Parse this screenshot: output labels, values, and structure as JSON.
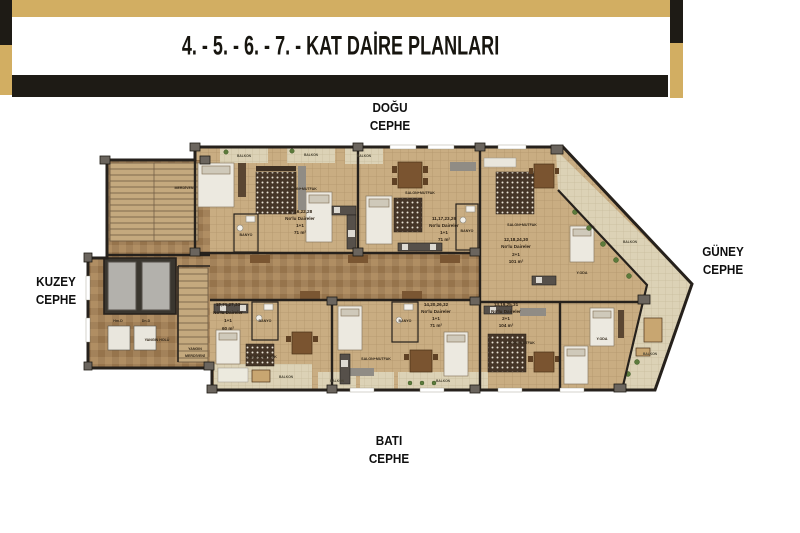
{
  "header": {
    "title": "4. - 5. - 6. - 7. - KAT DAİRE PLANLARI"
  },
  "compass": {
    "east": {
      "line1": "DOĞU",
      "line2": "CEPHE"
    },
    "north": {
      "line1": "KUZEY",
      "line2": "CEPHE"
    },
    "south": {
      "line1": "GÜNEY",
      "line2": "CEPHE"
    },
    "west": {
      "line1": "BATI",
      "line2": "CEPHE"
    }
  },
  "units": [
    {
      "id": "unit-10",
      "numbers": "10,16,22,28",
      "subtitle": "No'lu Daireler",
      "type": "1+1",
      "area": "71 m²"
    },
    {
      "id": "unit-11",
      "numbers": "11,17,23,29",
      "subtitle": "No'lu Daireler",
      "type": "1+1",
      "area": "71 m²"
    },
    {
      "id": "unit-12",
      "numbers": "12,18,24,30",
      "subtitle": "No'lu Daireler",
      "type": "2+1",
      "area": "101 m²"
    },
    {
      "id": "unit-13",
      "numbers": "13,19,25,31",
      "subtitle": "No'lu Daireler",
      "type": "2+1",
      "area": "104 m²"
    },
    {
      "id": "unit-14",
      "numbers": "14,20,26,32",
      "subtitle": "No'lu Daireler",
      "type": "1+1",
      "area": "71 m²"
    },
    {
      "id": "unit-15",
      "numbers": "15,21,27,33",
      "subtitle": "No'lu Daireler",
      "type": "1+1",
      "area": "60 m²"
    }
  ],
  "rooms": {
    "salon": "SALON+MUTFAK",
    "banyo": "BANYO",
    "balkon": "BALKON",
    "merdiven": "MERDİVEN",
    "yangin_holu": "YANGIN HOLÜ",
    "yangin_1": "YANGIN",
    "yangin_2": "MERDİVENİ",
    "elevator_1": "Hm.D",
    "elevator_2": "Dn.D",
    "yoda": "Y.ODA"
  },
  "colors": {
    "gold": "#d2ae62",
    "black_band": "#1e1b15",
    "wall": "#26211c",
    "floor_tile": "#c9ad82",
    "corridor": "#a3825a",
    "balcony": "#dcd2b6",
    "accent_gray": "#6b655e"
  }
}
